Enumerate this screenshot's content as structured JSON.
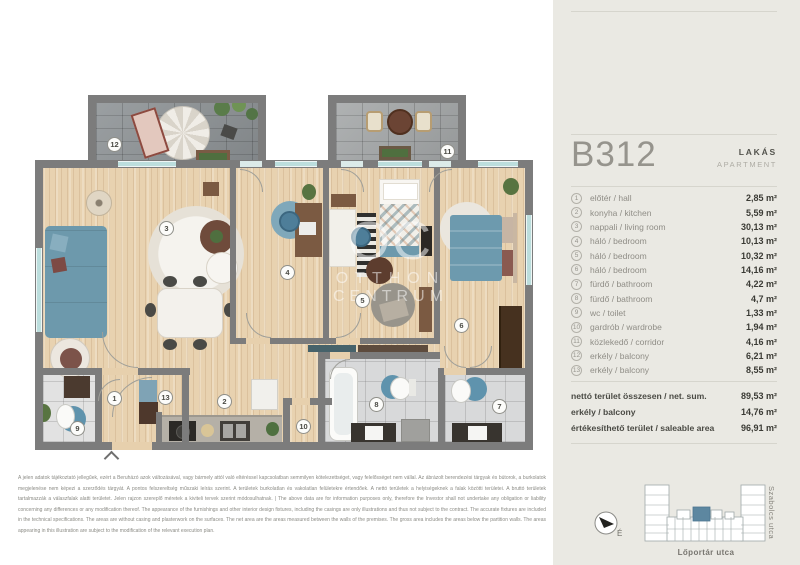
{
  "panel": {
    "unit_id": "B312",
    "type_hu": "LAKÁS",
    "type_en": "APARTMENT",
    "rooms": [
      {
        "num": "1",
        "label": "előtér / hall",
        "area": "2,85 m²"
      },
      {
        "num": "2",
        "label": "konyha / kitchen",
        "area": "5,59 m²"
      },
      {
        "num": "3",
        "label": "nappali / living room",
        "area": "30,13 m²"
      },
      {
        "num": "4",
        "label": "háló / bedroom",
        "area": "10,13 m²"
      },
      {
        "num": "5",
        "label": "háló / bedroom",
        "area": "10,32 m²"
      },
      {
        "num": "6",
        "label": "háló / bedroom",
        "area": "14,16 m²"
      },
      {
        "num": "7",
        "label": "fürdő / bathroom",
        "area": "4,22 m²"
      },
      {
        "num": "8",
        "label": "fürdő / bathroom",
        "area": "4,7 m²"
      },
      {
        "num": "9",
        "label": "wc / toilet",
        "area": "1,33 m²"
      },
      {
        "num": "10",
        "label": "gardrób / wardrobe",
        "area": "1,94 m²"
      },
      {
        "num": "11",
        "label": "közlekedő / corridor",
        "area": "4,16 m²"
      },
      {
        "num": "12",
        "label": "erkély / balcony",
        "area": "6,21 m²"
      },
      {
        "num": "13",
        "label": "erkély / balcony",
        "area": "8,55 m²"
      }
    ],
    "totals": [
      {
        "label": "nettó terület összesen / net. sum.",
        "value": "89,53 m²"
      },
      {
        "label": "erkély / balcony",
        "value": "14,76 m²"
      },
      {
        "label": "értékesíthető terület / saleable area",
        "value": "96,91 m²"
      }
    ]
  },
  "plan": {
    "watermark_initials": "OC",
    "watermark_line1": "OTTHON",
    "watermark_line2": "CENTRUM"
  },
  "footer": {
    "disclaimer": "A jelen adatok tájékoztató jellegűek, ezért a Beruházó azok változásával, vagy bármely attól való eltéréssel kapcsolatban semmilyen kötelezettséget, vagy felelősséget nem vállal. Az ábrázolt berendezési tárgyak és bútorok, a burkolatok megjelenése nem képezi a szerződés tárgyát. A pontos felszereltség műszaki leírás szerint. A területek burkolatlan és vakolatlan felületekre értendőek. A nettó területek a helyiségeknek a falak közötti területei. A bruttó területek tartalmazzák a válaszfalak alatti területet. Jelen rajzon szereplő méretek a kiviteli tervek szerint módosulhatnak. | The above data are for information purposes only, therefore the Investor shall not undertake any obligation or liability concerning any differences or any modification thereof. The appearance of the furnishings and other interior design fixtures, including the casings are only illustrations and thus not subject to the contract. The accurate fixtures are included in the technical specifications. The areas are without casing and plasterwork on the surfaces. The net area are the areas measured between the walls of the premises. The gross area includes the areas below the partition walls. The areas appearing in this illustration are subject to the modification of the relevant execution plan."
  },
  "map": {
    "street_right": "Szabolcs utca",
    "street_bottom": "Lőportár utca",
    "compass_north": "É"
  },
  "colors": {
    "panel_bg": "#eae9e3",
    "wall_gray": "#7c7c7c",
    "wood_floor": "#e8d2b0",
    "accent_blue": "#6d99ac",
    "map_highlight_unit": "#5d87a0",
    "window_teal": "#bcdedd"
  }
}
